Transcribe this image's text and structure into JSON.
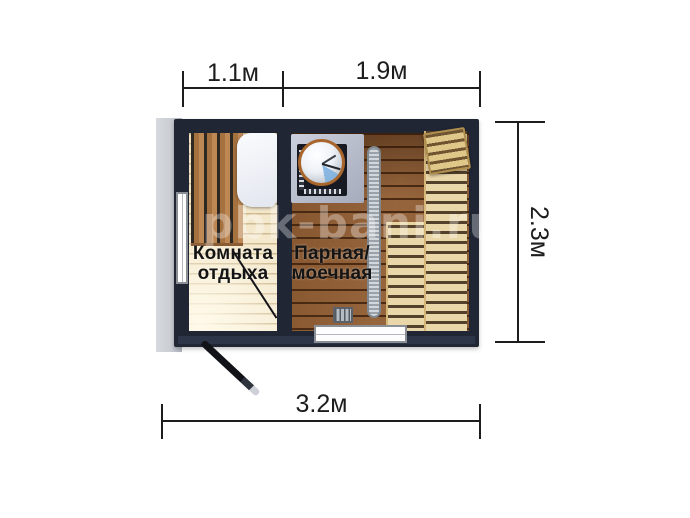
{
  "dimension_labels": {
    "top_left_width": "1.1м",
    "top_right_width": "1.9м",
    "depth": "2.3м",
    "total_width": "3.2м"
  },
  "room_labels": {
    "rest_line1": "Комната",
    "rest_line2": "отдыха",
    "steam_line1": "Парная/",
    "steam_line2": "моечная"
  },
  "watermark_text": "pbk-bani.ru",
  "palette": {
    "wall": "#202634",
    "exterior_ground": "#c9cdd3",
    "rest_floor": "#f0e2c2",
    "steam_floor": "#96653c",
    "bench_light_wood": "#ead7a9",
    "bench_dark_wood": "#a5713f",
    "drain_metal": "#d2d7dc",
    "stove_platform": "#a6abbc",
    "dimension_line": "#1d1d1d",
    "label_text": "#141414"
  }
}
